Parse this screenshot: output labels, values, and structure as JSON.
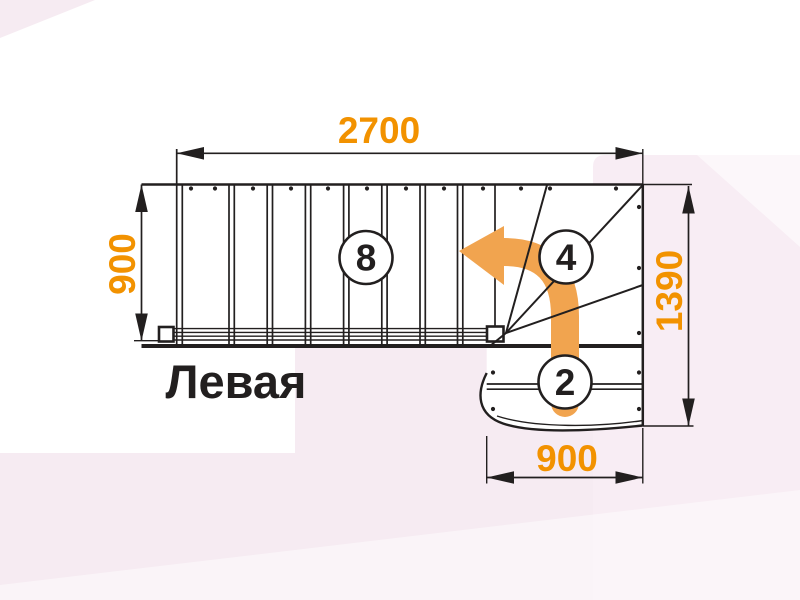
{
  "title": "Левая",
  "dims": {
    "top": "2700",
    "left": "900",
    "right": "1390",
    "bottom": "900"
  },
  "steps": {
    "main": "8",
    "winder": "4",
    "lower": "2"
  },
  "colors": {
    "dimension_text": "#F29200",
    "direction_arrow": "#F1A44F",
    "drawing_line": "#221F1F",
    "background_tint": "#F6EBF2"
  }
}
